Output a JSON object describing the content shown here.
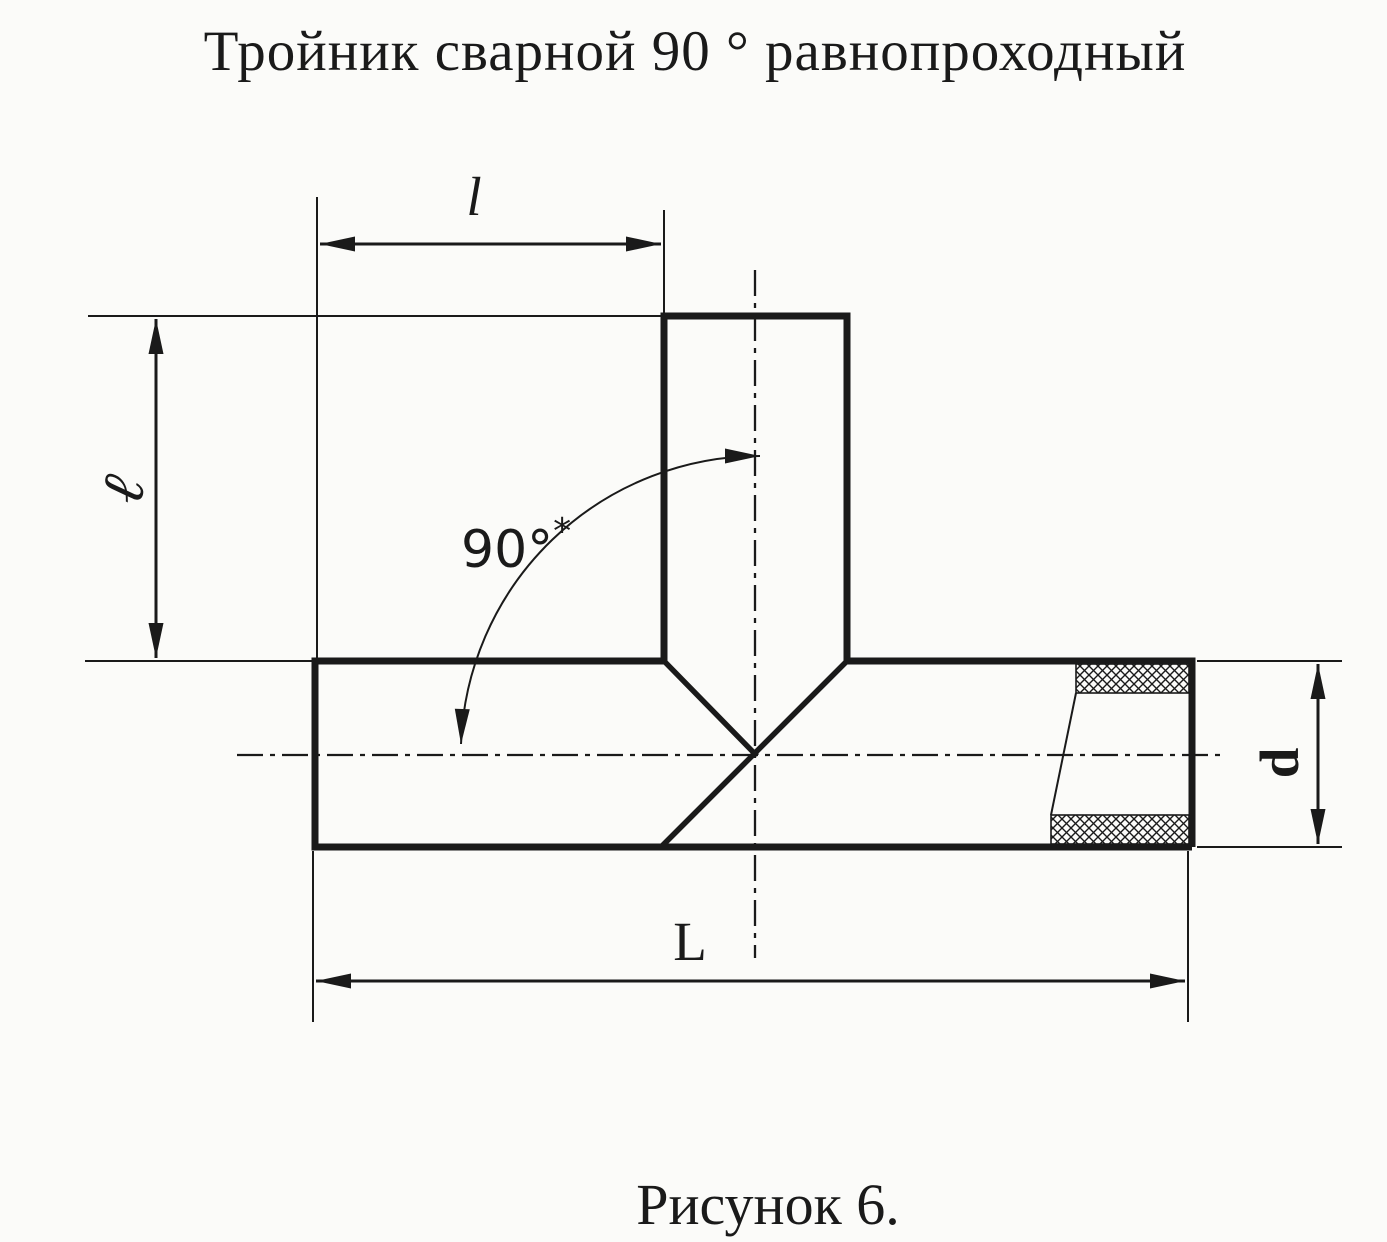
{
  "title": "Тройник сварной 90 ° равнопроходный",
  "caption": "Рисунок 6.",
  "labels": {
    "branch_extension_length": "l",
    "branch_height": "ℓ",
    "overall_length": "L",
    "outer_diameter": "d",
    "angle": "90°",
    "angle_footnote": "*"
  },
  "colors": {
    "ink": "#1a1a1a",
    "paper": "#fbfbf9"
  }
}
